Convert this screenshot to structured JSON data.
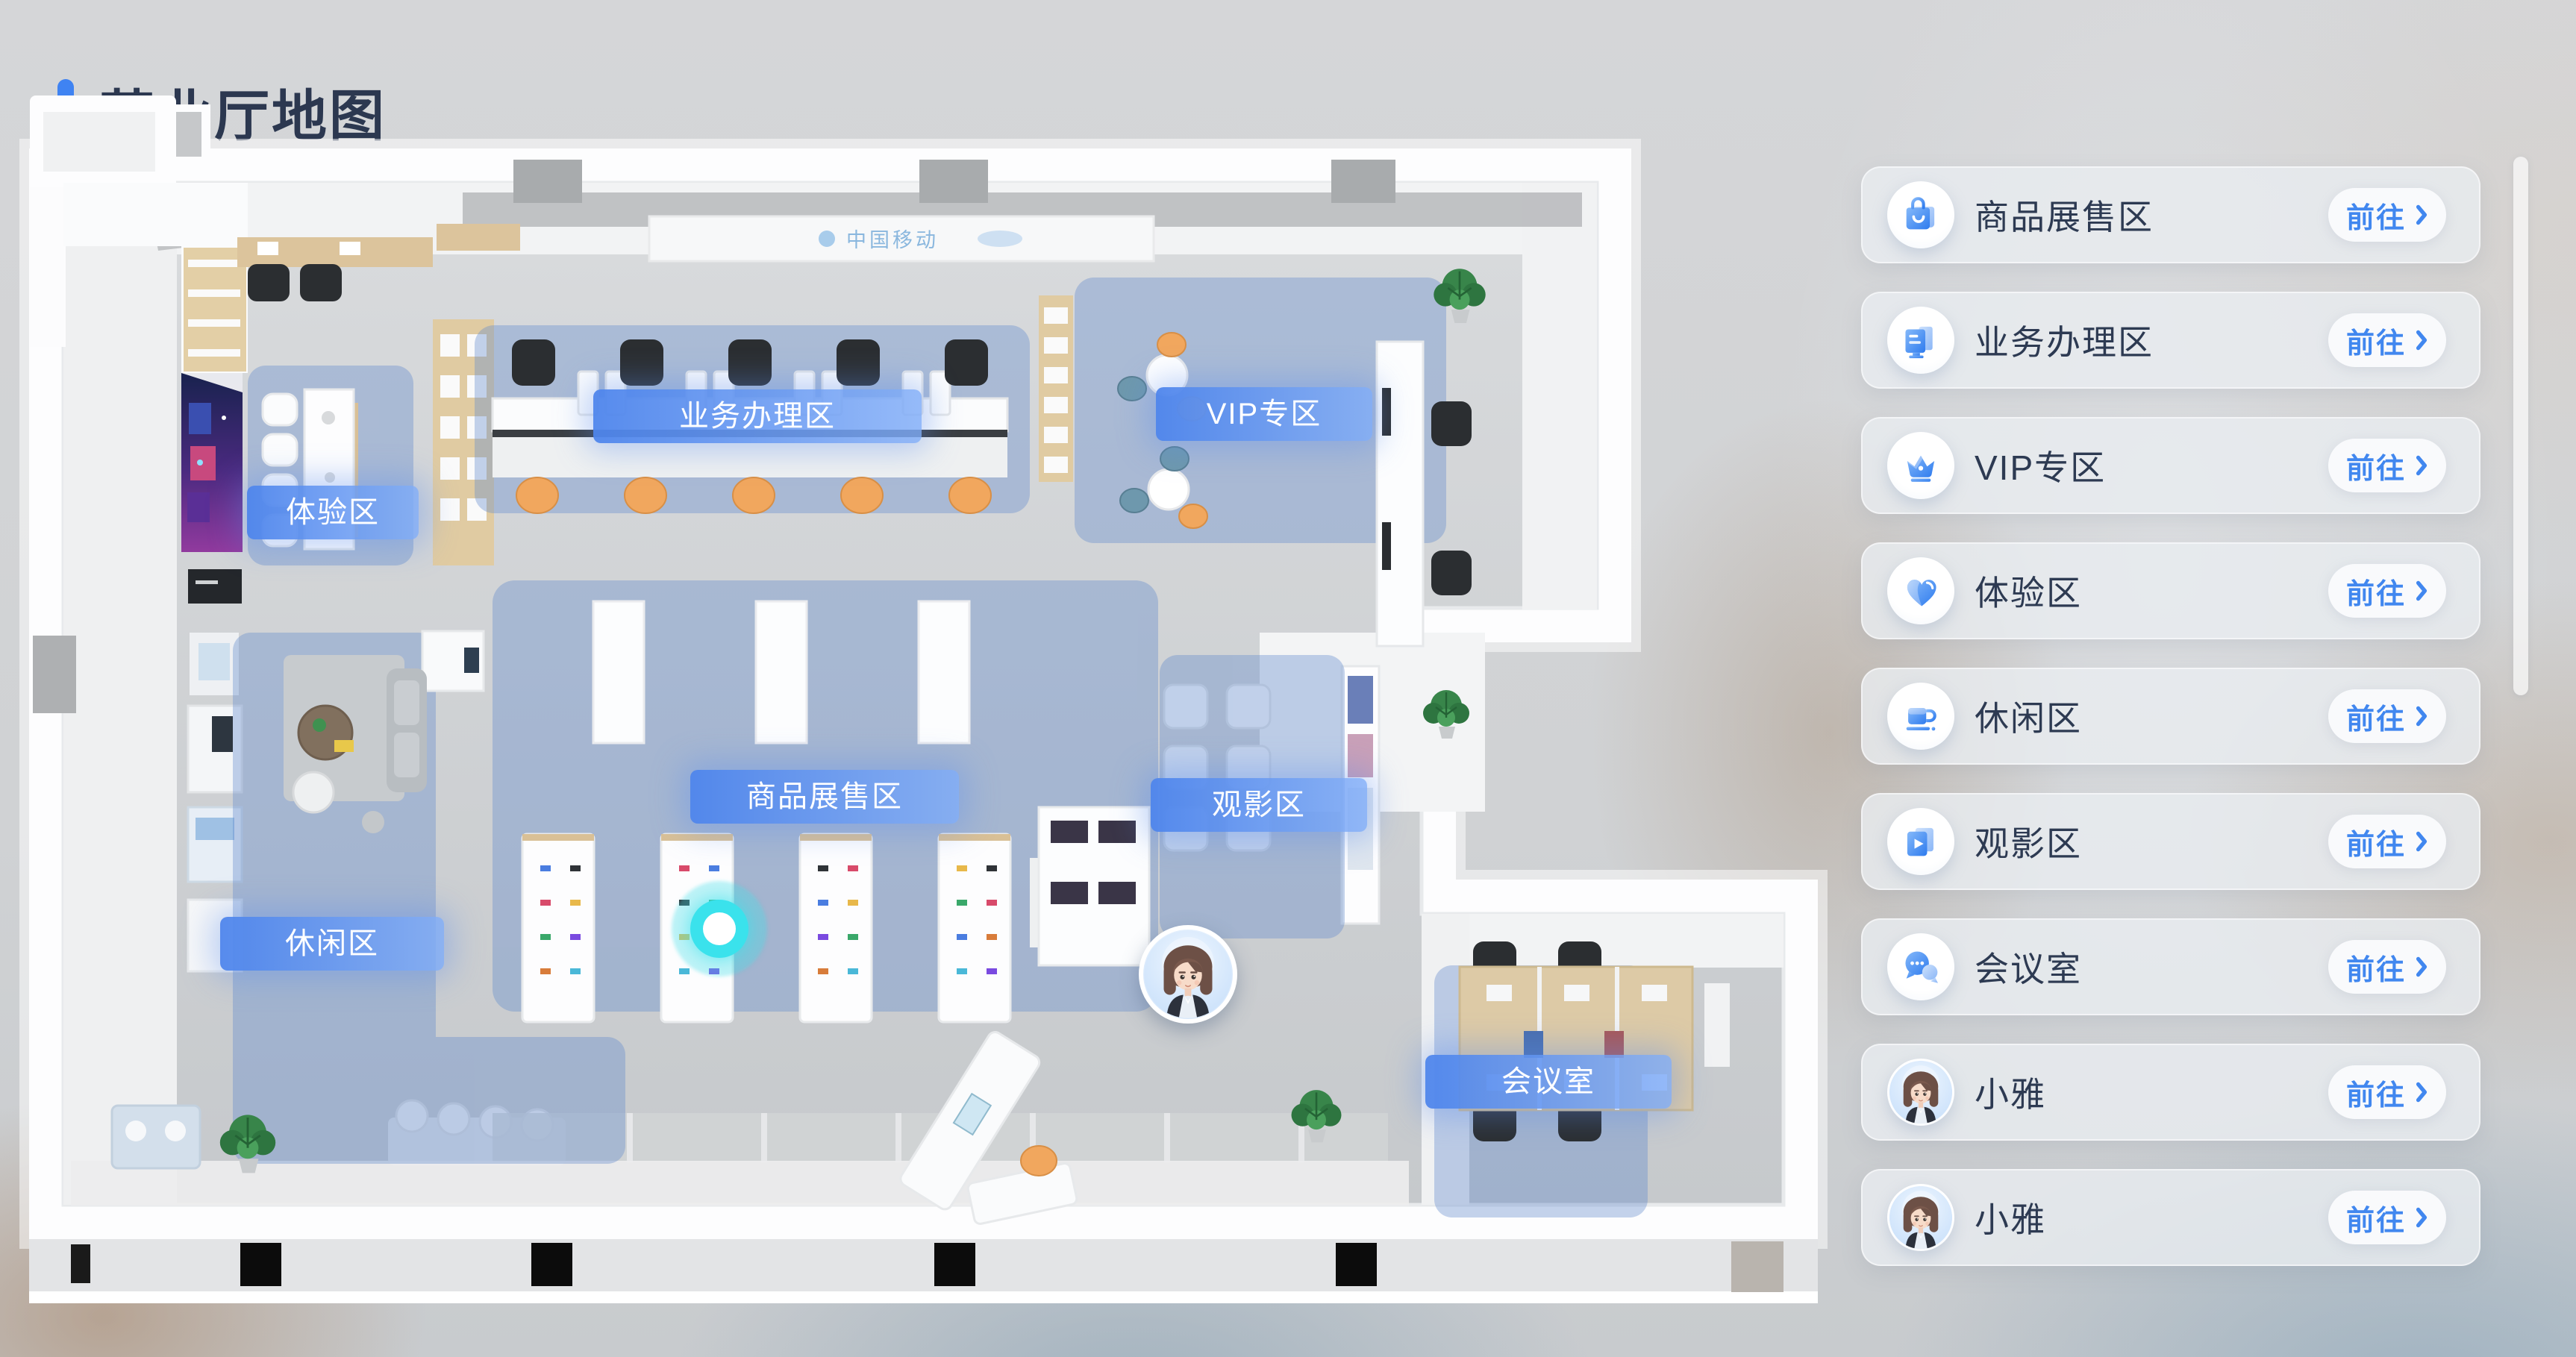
{
  "page_title": "营业厅地图",
  "map": {
    "zones": [
      {
        "id": "business",
        "label": "业务办理区"
      },
      {
        "id": "vip",
        "label": "VIP专区"
      },
      {
        "id": "experience",
        "label": "体验区"
      },
      {
        "id": "products",
        "label": "商品展售区"
      },
      {
        "id": "cinema",
        "label": "观影区"
      },
      {
        "id": "leisure",
        "label": "休闲区"
      },
      {
        "id": "meeting",
        "label": "会议室"
      }
    ],
    "wall_sign": "中国移动",
    "markers": {
      "current_location": "cyan-glow-dot",
      "guide_avatar": "小雅"
    }
  },
  "sidebar": {
    "items": [
      {
        "label": "商品展售区",
        "action": "前往",
        "icon": "shopping-bag"
      },
      {
        "label": "业务办理区",
        "action": "前往",
        "icon": "monitor"
      },
      {
        "label": "VIP专区",
        "action": "前往",
        "icon": "crown"
      },
      {
        "label": "体验区",
        "action": "前往",
        "icon": "heart"
      },
      {
        "label": "休闲区",
        "action": "前往",
        "icon": "coffee-cup"
      },
      {
        "label": "观影区",
        "action": "前往",
        "icon": "video"
      },
      {
        "label": "会议室",
        "action": "前往",
        "icon": "chat-bubbles"
      },
      {
        "label": "小雅",
        "action": "前往",
        "icon": "avatar"
      },
      {
        "label": "小雅",
        "action": "前往",
        "icon": "avatar"
      }
    ]
  },
  "colors": {
    "accent_blue": "#3f83f2",
    "button_blue": "#4187ef",
    "title_text": "#2c3850",
    "zone_overlay": "#648ccd",
    "location_dot": "#3ae2ec",
    "zone_label_gradient_start": "#4e85ec",
    "zone_label_gradient_end": "#7facf8"
  }
}
